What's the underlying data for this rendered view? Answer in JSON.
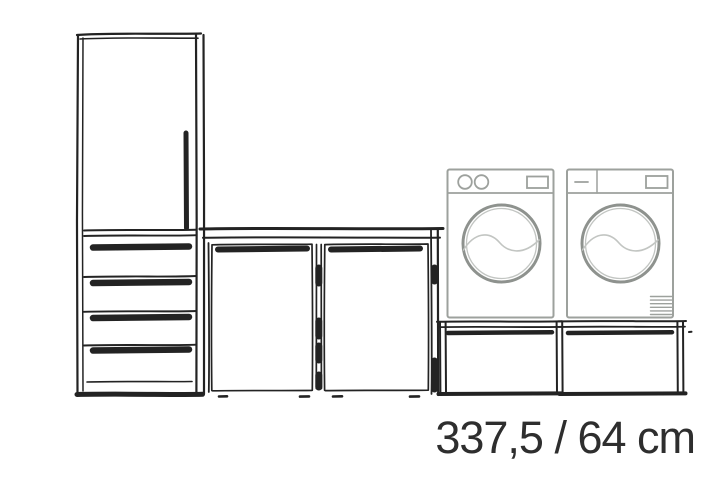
{
  "canvas": {
    "background": "#ffffff",
    "width": 718,
    "height": 503
  },
  "caption": {
    "text": "337,5 / 64 cm",
    "color": "#2e2e2e"
  },
  "colors": {
    "sketch": "#232323",
    "appliance": "#9da19d",
    "door_ring": "#8e928e",
    "door_inner": "#c2c5c2"
  },
  "scene": {
    "description": "hand-sketched laundry wall elevation",
    "tall_cabinet": {
      "drawer_count": 4,
      "door_count": 1
    },
    "base_cabinet": {
      "door_count": 2
    },
    "washing_machine": {
      "knob_count": 2
    },
    "tumble_dryer": {
      "vent_grille": true
    },
    "appliance_stands": {
      "count": 2
    }
  }
}
